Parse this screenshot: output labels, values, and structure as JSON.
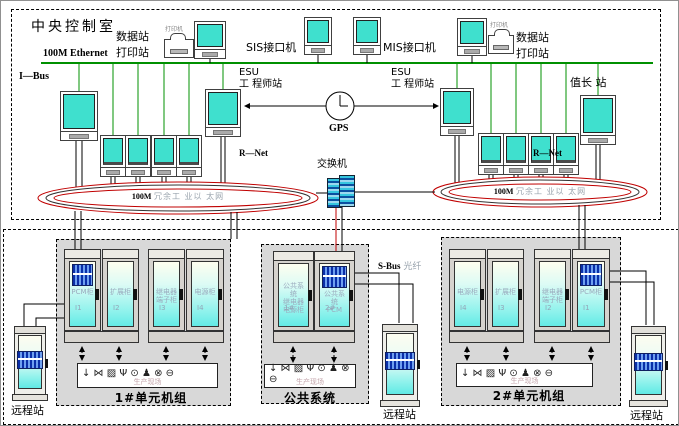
{
  "diagram_title": "中央控制室",
  "control_room": {
    "ethernet_label": "100M Ethernet",
    "ibus_label": "I—Bus",
    "data_print_station_left": "数据站\n打印站",
    "data_print_station_right": "数据站\n打印站",
    "printer_tag_left": "打印机",
    "printer_tag_right": "打印机",
    "sis_label": "SIS接口机",
    "mis_label": "MIS接口机",
    "esu_left": "ESU\n工 程师站",
    "esu_right": "ESU\n工 程师站",
    "gps_label": "GPS",
    "shift_leader_label": "值长 站",
    "rnet_left": "R—Net",
    "rnet_right": "R—Net",
    "switch_label": "交换机",
    "ring_left_speed": "100M",
    "ring_left_name": "冗余工 业以 太网",
    "ring_right_speed": "100M",
    "ring_right_name": "冗余工 业以 太网"
  },
  "field_level": {
    "sbus_label": "S-Bus",
    "sbus_media": "光纤",
    "remote_left": "远程站",
    "remote_mid": "远程站",
    "remote_right": "远程站",
    "unit1": {
      "label": "1#单元机组",
      "field_tag": "生产现场",
      "instrument_icons": "↓ ⋈ ▨ Ψ ⊙ ♟ ⊗ ⊖",
      "cabinets": [
        {
          "text": "PCM柜",
          "num": "I1"
        },
        {
          "text": "扩展柜",
          "num": "I2"
        },
        {
          "text": "继电器\n端子柜",
          "num": "I3"
        },
        {
          "text": "电源柜",
          "num": "I4"
        }
      ]
    },
    "common": {
      "label": "公共系统",
      "field_tag": "生产现场",
      "instrument_icons": "↓ ⋈ ▨ Ψ ⊙ ♟ ⊗ ⊖",
      "cabinets": [
        {
          "text": "公共系统\n继电器\n电源柜",
          "num": "1#"
        },
        {
          "text": "公共系统\nPCM",
          "num": "2#"
        }
      ]
    },
    "unit2": {
      "label": "2#单元机组",
      "field_tag": "生产现场",
      "instrument_icons": "↓ ⋈ ▨ Ψ ⊙ ♟ ⊗ ⊖",
      "cabinets": [
        {
          "text": "电源柜",
          "num": "I4"
        },
        {
          "text": "扩展柜",
          "num": "I3"
        },
        {
          "text": "继电器\n端子柜",
          "num": "I2"
        },
        {
          "text": "PCM柜",
          "num": "I1"
        }
      ]
    }
  },
  "colors": {
    "screen_teal": "#40E0D0",
    "ethernet_green": "#009000",
    "ring_red": "#C00000",
    "module_blue": "#1B3FC0",
    "box_gray": "#D8D8D8"
  }
}
